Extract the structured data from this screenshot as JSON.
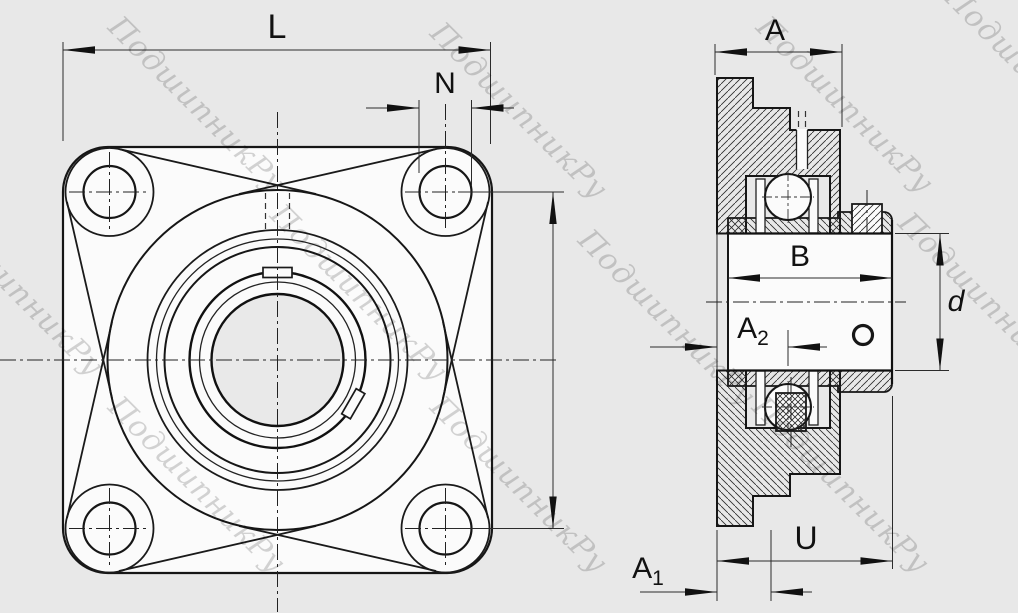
{
  "drawing": {
    "description": "Four-bolt square flanged bearing housing unit, front view and cross-section view",
    "views": {
      "front": "front-view",
      "section": "section-view"
    }
  },
  "dimensions": {
    "L": "L",
    "N": "N",
    "A": "A",
    "B": "B",
    "d": "d",
    "U": "U",
    "A1": {
      "main": "A",
      "sub": "1"
    },
    "A2": {
      "main": "A",
      "sub": "2"
    }
  },
  "watermark": {
    "text": "ПодшипникРу",
    "positions": [
      [
        190,
        112
      ],
      [
        512,
        118
      ],
      [
        838,
        112
      ],
      [
        1026,
        82
      ],
      [
        8,
        295
      ],
      [
        352,
        300
      ],
      [
        660,
        325
      ],
      [
        980,
        308
      ],
      [
        190,
        492
      ],
      [
        512,
        492
      ],
      [
        834,
        492
      ]
    ]
  },
  "colors": {
    "background": "#e8e8e8",
    "part_fill": "#fbfbfb",
    "line": "#161616",
    "bore_fill": "#e9e9e9",
    "watermark": "#c6c6c6"
  }
}
